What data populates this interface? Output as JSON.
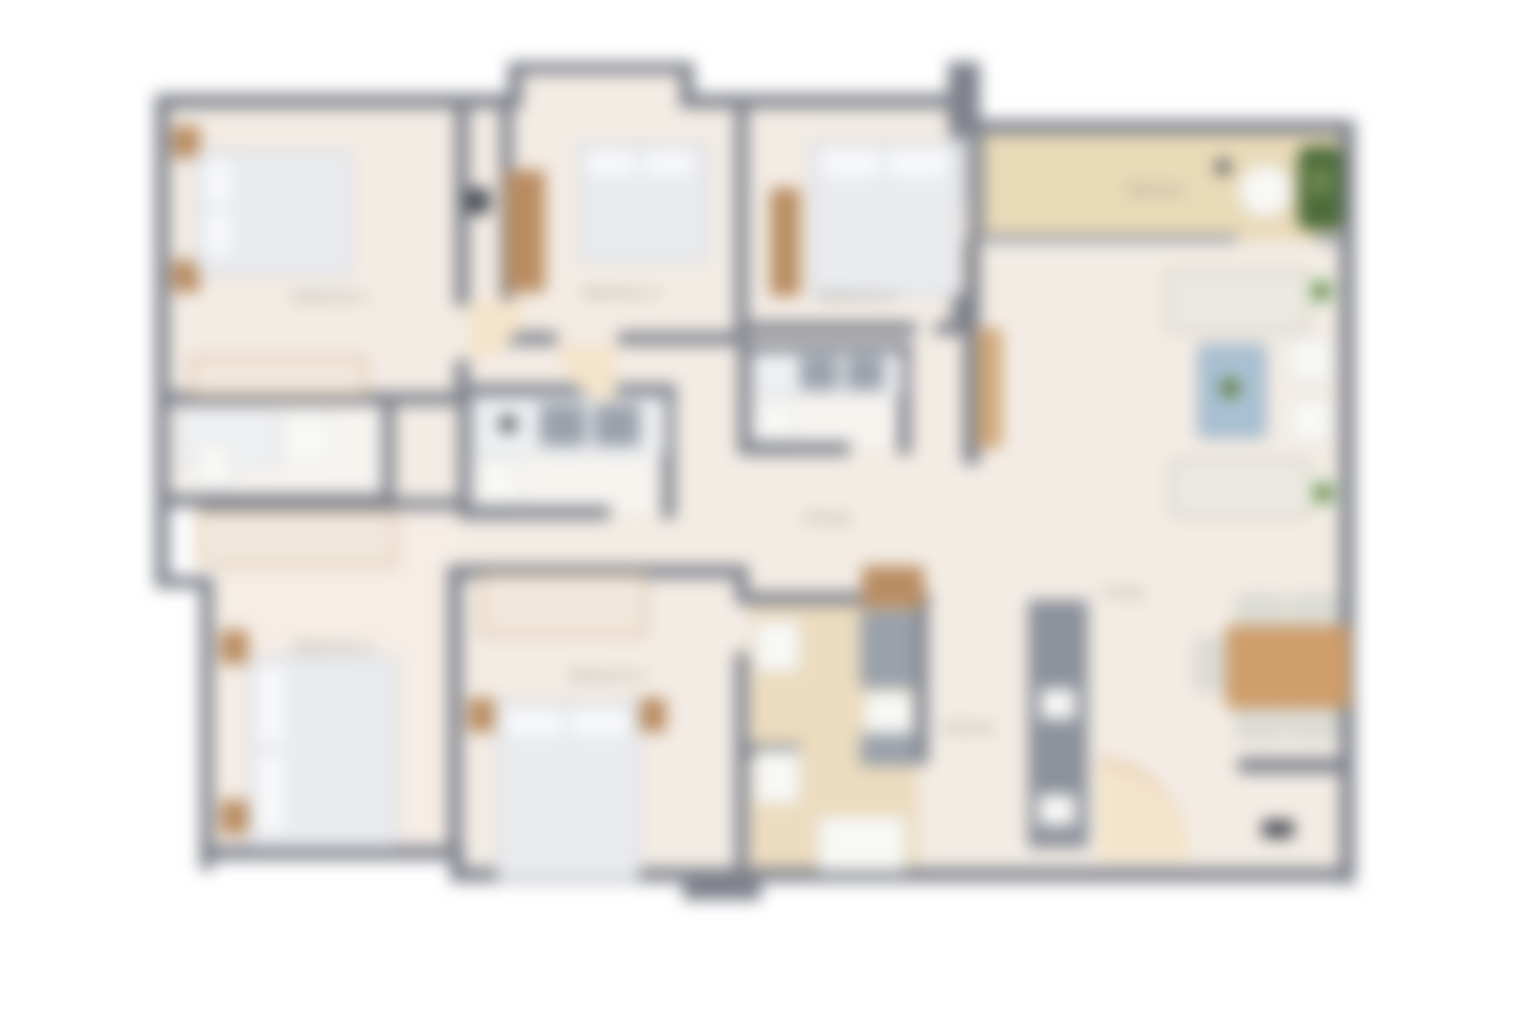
{
  "page": {
    "background": "#ffffff",
    "description": "Blurred top-down architectural floor plan of a five-bedroom apartment"
  },
  "floor_plan": {
    "labels": {
      "bedroom1": "Bedroom 1",
      "bedroom2": "Bedroom 2",
      "bedroom3": "Bedroom 3",
      "bedroom4": "Bedroom 4",
      "bedroom5": "Bedroom 5",
      "dining": "Dining",
      "living": "Living",
      "kitchen": "Kitchen",
      "balcony": "Balcony"
    },
    "palette": {
      "wall": "#7d818b",
      "floor": "#f3ece5",
      "bathroom_floor": "#f7f4f0",
      "balcony_floor": "#e9dab8",
      "kitchen_floor": "#ecdcbf",
      "wood": "#b98d62",
      "bed_linen": "#e9ebee",
      "coffee_table_blue": "#a9c0d2",
      "plant_green": "#4d6b3a",
      "label_text": "#8f8e88"
    }
  }
}
